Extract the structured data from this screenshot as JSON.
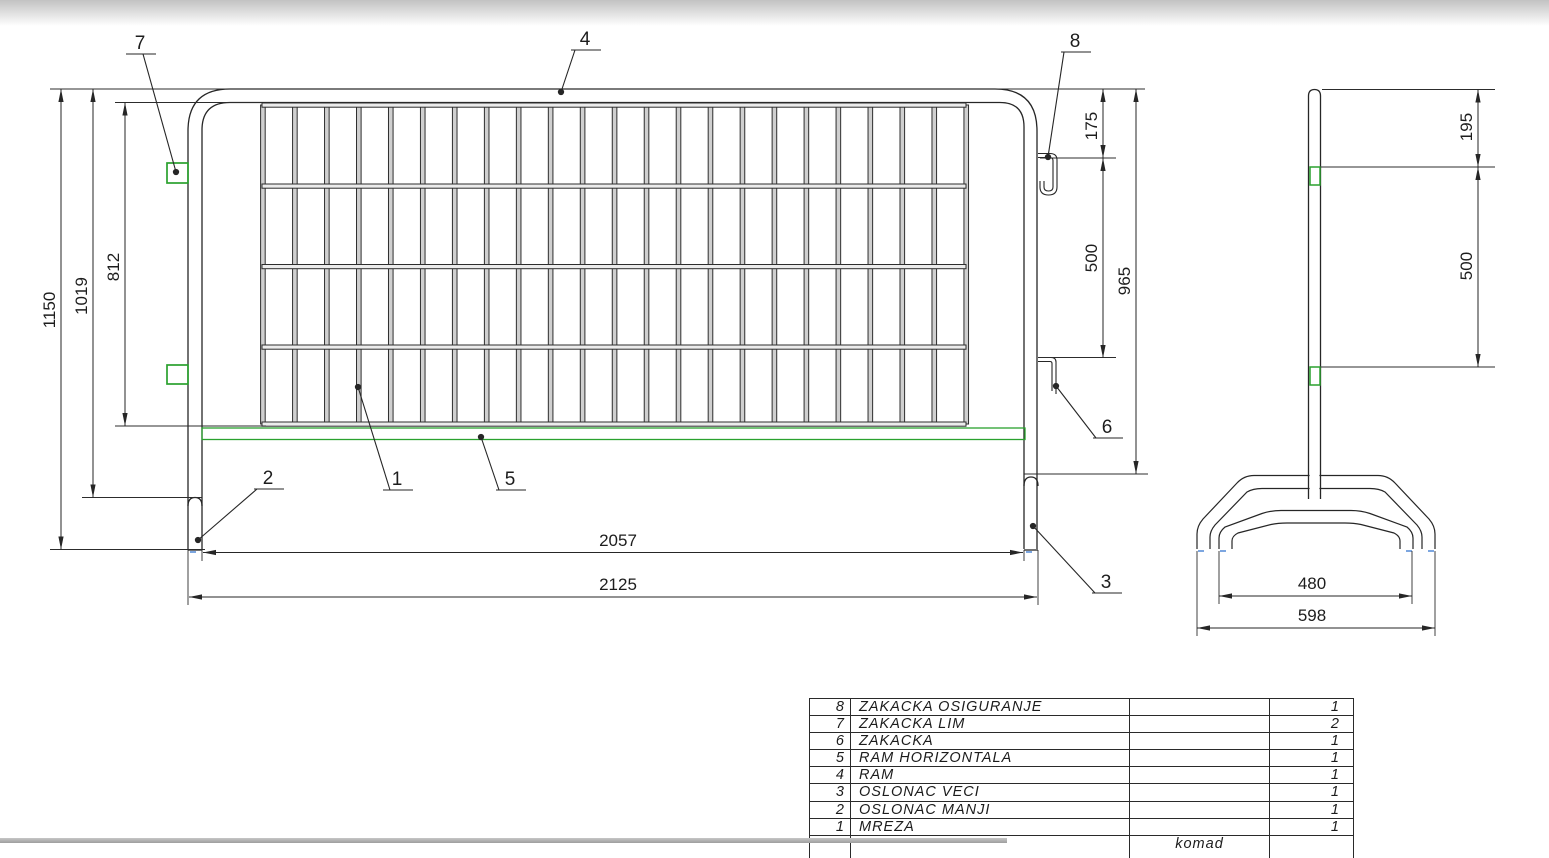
{
  "front_view": {
    "dim_total_height": "1150",
    "dim_height_to_foot": "1019",
    "dim_mesh_height": "812",
    "dim_hook_top_offset": "175",
    "dim_hook_spacing": "500",
    "dim_frame_height": "965",
    "dim_inner_width": "2057",
    "dim_outer_width": "2125"
  },
  "side_view": {
    "dim_top_to_hook": "195",
    "dim_hook_spacing": "500",
    "dim_base_inner": "480",
    "dim_base_outer": "598"
  },
  "callouts": {
    "c1": "1",
    "c2": "2",
    "c3": "3",
    "c4": "4",
    "c5": "5",
    "c6": "6",
    "c7": "7",
    "c8": "8"
  },
  "parts_table": {
    "rows": [
      {
        "no": "8",
        "name": "ZAKACKA OSIGURANJE",
        "spec": "",
        "qty": "1"
      },
      {
        "no": "7",
        "name": "ZAKACKA LIM",
        "spec": "",
        "qty": "2"
      },
      {
        "no": "6",
        "name": "ZAKACKA",
        "spec": "",
        "qty": "1"
      },
      {
        "no": "5",
        "name": "RAM HORIZONTALA",
        "spec": "",
        "qty": "1"
      },
      {
        "no": "4",
        "name": "RAM",
        "spec": "",
        "qty": "1"
      },
      {
        "no": "3",
        "name": "OSLONAC VECI",
        "spec": "",
        "qty": "1"
      },
      {
        "no": "2",
        "name": "OSLONAC MANJI",
        "spec": "",
        "qty": "1"
      },
      {
        "no": "1",
        "name": "MREZA",
        "spec": "",
        "qty": "1"
      }
    ],
    "partial_footer_label": "komad"
  },
  "colors": {
    "line": "#262626",
    "accent_green": "#2aa12e",
    "accent_blue": "#5c8fd9"
  }
}
